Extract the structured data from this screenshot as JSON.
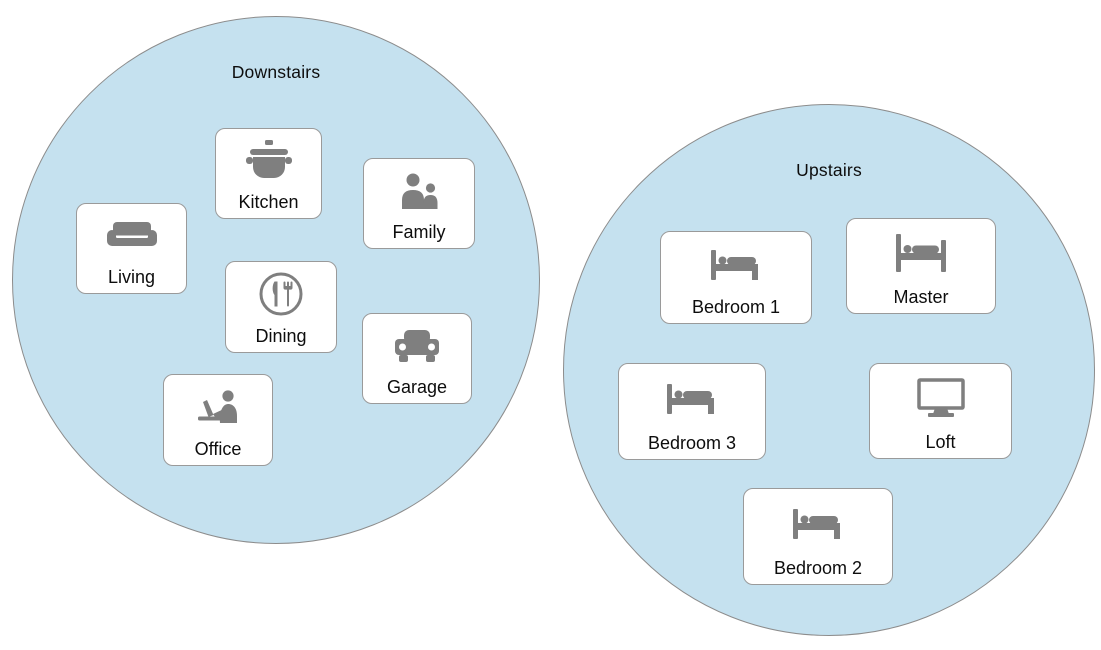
{
  "groups": [
    {
      "label": "Downstairs",
      "rooms": [
        {
          "label": "Kitchen",
          "icon": "pot-icon"
        },
        {
          "label": "Family",
          "icon": "people-icon"
        },
        {
          "label": "Living",
          "icon": "couch-icon"
        },
        {
          "label": "Dining",
          "icon": "cutlery-icon"
        },
        {
          "label": "Garage",
          "icon": "car-icon"
        },
        {
          "label": "Office",
          "icon": "person-laptop-icon"
        }
      ]
    },
    {
      "label": "Upstairs",
      "rooms": [
        {
          "label": "Bedroom 1",
          "icon": "bed-icon"
        },
        {
          "label": "Master",
          "icon": "bed-posts-icon"
        },
        {
          "label": "Bedroom 3",
          "icon": "bed-icon"
        },
        {
          "label": "Loft",
          "icon": "monitor-icon"
        },
        {
          "label": "Bedroom 2",
          "icon": "bed-icon"
        }
      ]
    }
  ],
  "colors": {
    "zone_fill": "#C5E1EF",
    "zone_border": "#8C8C8C",
    "card_fill": "#FFFFFF",
    "card_border": "#9A9A9A",
    "icon_gray": "#7F7F7F",
    "text": "#0D0D0D"
  }
}
